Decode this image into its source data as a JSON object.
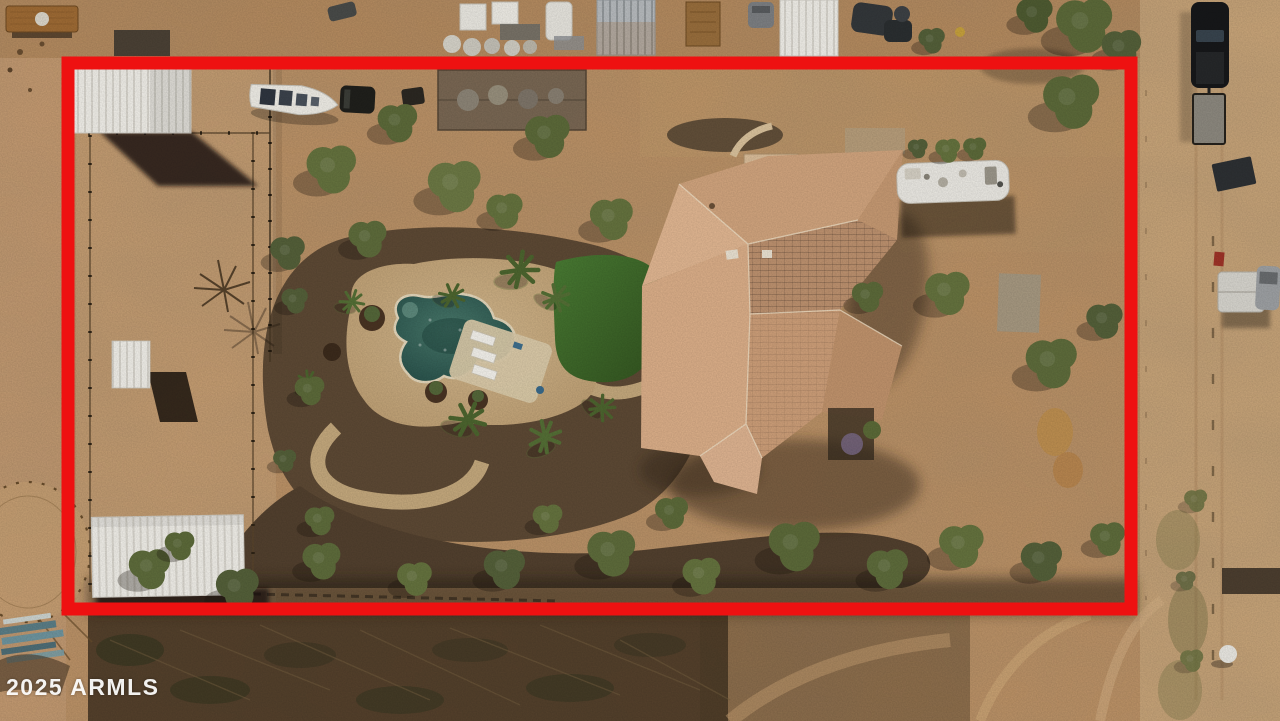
{
  "meta": {
    "description": "Top-down aerial drone photograph of a desert residential horse property; the lot is outlined with a thick red boundary overlay (real-estate listing photo)."
  },
  "watermark": {
    "text": "2025 ARMLS",
    "color": "#ffffff"
  },
  "boundary": {
    "shape": "rectangle",
    "color": "#ee1111",
    "x": 68,
    "y": 63,
    "width": 1063,
    "height": 546,
    "stroke_width": 13
  },
  "palette": {
    "dirt_base": "#c09467",
    "dirt_paddock": "#cda67b",
    "dirt_road": "#cda87b",
    "dirt_neighbor": "#b5895c",
    "mulch_dark": "#5e4a35",
    "scrub_dark": "#493926",
    "pool_water": "#2f5d54",
    "pool_deck": "#c9ad82",
    "turf_green": "#3e682d",
    "tree_green": "#66743f",
    "roof_light": "#e3b893",
    "roof_mid": "#d3a67f",
    "roof_dark": "#bf9370",
    "metal_white": "#f3f1eb"
  },
  "scene_objects": [
    {
      "id": "main-house",
      "label": "Large tan tile-roof house"
    },
    {
      "id": "swimming-pool",
      "label": "Free-form swimming pool"
    },
    {
      "id": "pool-deck",
      "label": "Pool deck with white lounge chairs"
    },
    {
      "id": "turf-lawn",
      "label": "Green lawn beside pool"
    },
    {
      "id": "metal-barn",
      "label": "White metal barn (top left)"
    },
    {
      "id": "storage-shed",
      "label": "White storage shed (bottom left)"
    },
    {
      "id": "shade-structure",
      "label": "Paddock shade shelter"
    },
    {
      "id": "horse-paddock",
      "label": "Fenced dirt paddock"
    },
    {
      "id": "round-pen",
      "label": "Round pen outside west fence"
    },
    {
      "id": "boat",
      "label": "White boat on trailer"
    },
    {
      "id": "rv-motorhome",
      "label": "White RV motorhome beside house"
    },
    {
      "id": "pickup-and-trailer",
      "label": "Dark pickup truck with flatbed trailer on road"
    },
    {
      "id": "dirt-road",
      "label": "Dirt road along east side"
    },
    {
      "id": "neighbor-outbuildings",
      "label": "Neighboring sheds, tanks and vehicles (top strip)"
    },
    {
      "id": "desert-trees",
      "label": "Desert trees and palms"
    }
  ]
}
